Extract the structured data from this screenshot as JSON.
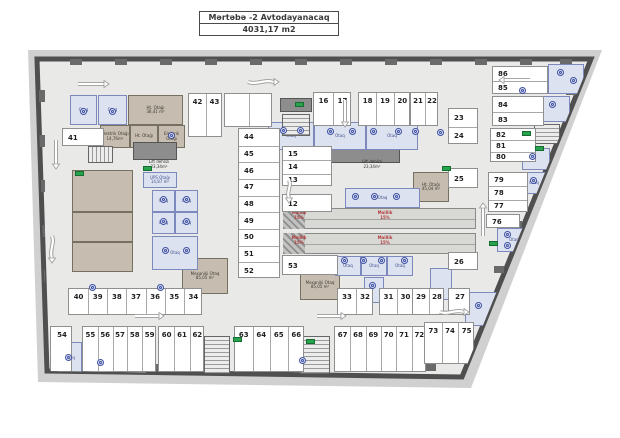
{
  "title": {
    "line1": "Mərtəbə -2 Avtodayanacaq",
    "line2": "4031,17 m2"
  },
  "plan": {
    "colors": {
      "wall": "#4f4f4f",
      "floor": "#e9e9e7",
      "outer_band": "#d0d0d0",
      "stall": "#ffffff",
      "tan_room": "#c6bdb0",
      "blue_room": "#dde2f1",
      "ramp_text": "#b23b3b",
      "exit_green": "#28a24c",
      "vent_blue": "#3f51a3"
    },
    "outline": [
      [
        37,
        59
      ],
      [
        591,
        59
      ],
      [
        462,
        377
      ],
      [
        47,
        371
      ]
    ],
    "outer_band": [
      [
        28,
        50
      ],
      [
        602,
        50
      ],
      [
        471,
        388
      ],
      [
        38,
        382
      ]
    ],
    "stall_groups": [
      {
        "orient": "v",
        "x": 313,
        "y": 92,
        "w": 38,
        "h": 34,
        "numbers": [
          "16",
          "17"
        ]
      },
      {
        "orient": "v",
        "x": 358,
        "y": 92,
        "w": 52,
        "h": 34,
        "numbers": [
          "18",
          "19",
          "20"
        ]
      },
      {
        "orient": "v",
        "x": 410,
        "y": 92,
        "w": 28,
        "h": 34,
        "numbers": [
          "21",
          "22"
        ]
      },
      {
        "orient": "v",
        "x": 188,
        "y": 93,
        "w": 34,
        "h": 44,
        "numbers": [
          "42",
          "43"
        ]
      },
      {
        "orient": "v",
        "x": 224,
        "y": 93,
        "w": 48,
        "h": 34,
        "numbers": [
          "",
          ""
        ]
      },
      {
        "orient": "h",
        "x": 62,
        "y": 128,
        "w": 42,
        "h": 18,
        "numbers": [
          "41"
        ]
      },
      {
        "orient": "h",
        "x": 238,
        "y": 128,
        "w": 42,
        "h": 150,
        "numbers": [
          "44",
          "45",
          "46",
          "47",
          "48",
          "49",
          "50",
          "51",
          "52"
        ]
      },
      {
        "orient": "h",
        "x": 282,
        "y": 146,
        "w": 50,
        "h": 40,
        "numbers": [
          "15",
          "14",
          "13"
        ]
      },
      {
        "orient": "h",
        "x": 282,
        "y": 194,
        "w": 50,
        "h": 18,
        "numbers": [
          "12"
        ]
      },
      {
        "orient": "h",
        "x": 282,
        "y": 255,
        "w": 56,
        "h": 20,
        "numbers": [
          "53"
        ]
      },
      {
        "orient": "h",
        "x": 448,
        "y": 108,
        "w": 30,
        "h": 36,
        "numbers": [
          "23",
          "24"
        ]
      },
      {
        "orient": "h",
        "x": 448,
        "y": 168,
        "w": 30,
        "h": 20,
        "numbers": [
          "25"
        ]
      },
      {
        "orient": "h",
        "x": 448,
        "y": 252,
        "w": 30,
        "h": 18,
        "numbers": [
          "26"
        ]
      },
      {
        "orient": "h",
        "x": 492,
        "y": 66,
        "w": 56,
        "h": 28,
        "numbers": [
          "86",
          "85"
        ]
      },
      {
        "orient": "h",
        "x": 492,
        "y": 96,
        "w": 52,
        "h": 30,
        "numbers": [
          "84",
          "83"
        ]
      },
      {
        "orient": "h",
        "x": 490,
        "y": 128,
        "w": 46,
        "h": 34,
        "numbers": [
          "82",
          "81",
          "80"
        ]
      },
      {
        "orient": "h",
        "x": 488,
        "y": 172,
        "w": 40,
        "h": 40,
        "numbers": [
          "79",
          "78",
          "77"
        ]
      },
      {
        "orient": "h",
        "x": 486,
        "y": 214,
        "w": 34,
        "h": 14,
        "numbers": [
          "76"
        ]
      },
      {
        "orient": "v",
        "x": 68,
        "y": 288,
        "w": 134,
        "h": 27,
        "numbers": [
          "40",
          "39",
          "38",
          "37",
          "36",
          "35",
          "34"
        ]
      },
      {
        "orient": "v",
        "x": 337,
        "y": 288,
        "w": 36,
        "h": 27,
        "numbers": [
          "33",
          "32"
        ]
      },
      {
        "orient": "v",
        "x": 379,
        "y": 288,
        "w": 34,
        "h": 27,
        "numbers": [
          "31",
          "30"
        ]
      },
      {
        "orient": "v",
        "x": 412,
        "y": 288,
        "w": 32,
        "h": 27,
        "numbers": [
          "29",
          "28"
        ]
      },
      {
        "orient": "v",
        "x": 448,
        "y": 288,
        "w": 22,
        "h": 27,
        "numbers": [
          "27"
        ]
      },
      {
        "orient": "v",
        "x": 50,
        "y": 326,
        "w": 22,
        "h": 46,
        "numbers": [
          "54"
        ]
      },
      {
        "orient": "v",
        "x": 82,
        "y": 326,
        "w": 74,
        "h": 46,
        "numbers": [
          "55",
          "56",
          "57",
          "58",
          "59"
        ]
      },
      {
        "orient": "v",
        "x": 158,
        "y": 326,
        "w": 46,
        "h": 46,
        "numbers": [
          "60",
          "61",
          "62"
        ]
      },
      {
        "orient": "v",
        "x": 234,
        "y": 326,
        "w": 70,
        "h": 46,
        "numbers": [
          "63",
          "64",
          "65",
          "66"
        ]
      },
      {
        "orient": "v",
        "x": 334,
        "y": 326,
        "w": 92,
        "h": 46,
        "numbers": [
          "67",
          "68",
          "69",
          "70",
          "71",
          "72"
        ]
      },
      {
        "orient": "v",
        "x": 424,
        "y": 322,
        "w": 50,
        "h": 42,
        "numbers": [
          "73",
          "74",
          "75"
        ]
      }
    ],
    "rooms": [
      {
        "type": "blue",
        "x": 70,
        "y": 95,
        "w": 27,
        "h": 30,
        "label": "Otaq"
      },
      {
        "type": "blue",
        "x": 98,
        "y": 95,
        "w": 29,
        "h": 30,
        "label": "Otaq"
      },
      {
        "type": "tan",
        "x": 128,
        "y": 95,
        "w": 55,
        "h": 30,
        "label": "Ht. Otağı\n38,41 m²"
      },
      {
        "type": "tan",
        "x": 100,
        "y": 125,
        "w": 30,
        "h": 23,
        "label": "Elektrik Otağı\n14,76m²"
      },
      {
        "type": "tan",
        "x": 130,
        "y": 125,
        "w": 28,
        "h": 23,
        "label": "Ht. Otağı"
      },
      {
        "type": "tan",
        "x": 158,
        "y": 125,
        "w": 27,
        "h": 23,
        "label": "Elektrik\nOtağı"
      },
      {
        "type": "tan",
        "x": 72,
        "y": 170,
        "w": 61,
        "h": 42,
        "label": ""
      },
      {
        "type": "tan",
        "x": 72,
        "y": 212,
        "w": 61,
        "h": 30,
        "label": ""
      },
      {
        "type": "tan",
        "x": 72,
        "y": 242,
        "w": 61,
        "h": 30,
        "label": ""
      },
      {
        "type": "tan",
        "x": 182,
        "y": 258,
        "w": 46,
        "h": 36,
        "label": "Mexaniki Otaq\n85,05 m²"
      },
      {
        "type": "tan",
        "x": 300,
        "y": 270,
        "w": 40,
        "h": 30,
        "label": "Mexaniki Otaq\n85,05 m²"
      },
      {
        "type": "tan",
        "x": 413,
        "y": 172,
        "w": 36,
        "h": 30,
        "label": "Ht. Otağı\n45,04 m²"
      },
      {
        "type": "shaft",
        "x": 133,
        "y": 142,
        "w": 44,
        "h": 18,
        "label": ""
      },
      {
        "type": "shaft",
        "x": 322,
        "y": 145,
        "w": 78,
        "h": 18,
        "label": ""
      },
      {
        "type": "shaft",
        "x": 280,
        "y": 98,
        "w": 32,
        "h": 14,
        "label": ""
      },
      {
        "type": "blue",
        "x": 143,
        "y": 172,
        "w": 34,
        "h": 16,
        "label": "UPS Otağı\n14,87 m²"
      },
      {
        "type": "blue",
        "x": 152,
        "y": 190,
        "w": 23,
        "h": 22,
        "label": "Otaq"
      },
      {
        "type": "blue",
        "x": 175,
        "y": 190,
        "w": 23,
        "h": 22,
        "label": "Otaq"
      },
      {
        "type": "blue",
        "x": 152,
        "y": 212,
        "w": 23,
        "h": 22,
        "label": "Otaq"
      },
      {
        "type": "blue",
        "x": 175,
        "y": 212,
        "w": 23,
        "h": 22,
        "label": "Otaq"
      },
      {
        "type": "blue",
        "x": 152,
        "y": 236,
        "w": 46,
        "h": 34,
        "label": "Otaq"
      },
      {
        "type": "blue",
        "x": 268,
        "y": 122,
        "w": 46,
        "h": 28,
        "label": "Otaq"
      },
      {
        "type": "blue",
        "x": 314,
        "y": 122,
        "w": 52,
        "h": 28,
        "label": "Otaq"
      },
      {
        "type": "blue",
        "x": 366,
        "y": 122,
        "w": 52,
        "h": 28,
        "label": "Otaq"
      },
      {
        "type": "blue",
        "x": 345,
        "y": 188,
        "w": 75,
        "h": 20,
        "label": "Otaq"
      },
      {
        "type": "blue",
        "x": 335,
        "y": 256,
        "w": 26,
        "h": 20,
        "label": "Otaq"
      },
      {
        "type": "blue",
        "x": 361,
        "y": 256,
        "w": 26,
        "h": 20,
        "label": "Otaq"
      },
      {
        "type": "blue",
        "x": 387,
        "y": 256,
        "w": 26,
        "h": 20,
        "label": "Otaq"
      },
      {
        "type": "blue",
        "x": 364,
        "y": 277,
        "w": 20,
        "h": 26,
        "label": ""
      },
      {
        "type": "blue",
        "x": 430,
        "y": 268,
        "w": 22,
        "h": 32,
        "label": ""
      },
      {
        "type": "blue",
        "x": 58,
        "y": 342,
        "w": 24,
        "h": 32,
        "label": "Otaq"
      },
      {
        "type": "blue",
        "x": 84,
        "y": 352,
        "w": 62,
        "h": 24,
        "label": "Otaq"
      },
      {
        "type": "blue",
        "x": 548,
        "y": 64,
        "w": 36,
        "h": 30,
        "label": ""
      },
      {
        "type": "blue",
        "x": 540,
        "y": 96,
        "w": 30,
        "h": 26,
        "label": ""
      },
      {
        "type": "blue",
        "x": 522,
        "y": 148,
        "w": 28,
        "h": 22,
        "label": ""
      },
      {
        "type": "blue",
        "x": 520,
        "y": 172,
        "w": 28,
        "h": 22,
        "label": "Otaq"
      },
      {
        "type": "blue",
        "x": 497,
        "y": 228,
        "w": 34,
        "h": 24,
        "label": "Otaq"
      },
      {
        "type": "blue",
        "x": 514,
        "y": 262,
        "w": 26,
        "h": 36,
        "label": ""
      },
      {
        "type": "blue",
        "x": 465,
        "y": 292,
        "w": 32,
        "h": 34,
        "label": ""
      }
    ],
    "labels": [
      {
        "x": 136,
        "y": 160,
        "w": 46,
        "text": "Lift dehlizi\n23,34m²"
      },
      {
        "x": 348,
        "y": 160,
        "w": 48,
        "text": "Lift dehlizi\n23,34m²"
      }
    ],
    "ramps": {
      "bands": [
        {
          "x": 283,
          "y": 208,
          "w": 193,
          "h": 21
        },
        {
          "x": 283,
          "y": 233,
          "w": 193,
          "h": 21
        }
      ],
      "hatches": [
        {
          "x": 283,
          "y": 208,
          "w": 22,
          "h": 21
        },
        {
          "x": 283,
          "y": 233,
          "w": 22,
          "h": 21
        }
      ],
      "labels": [
        {
          "x": 286,
          "y": 211,
          "w": 26,
          "text": "Maillik\n15%"
        },
        {
          "x": 372,
          "y": 211,
          "w": 26,
          "text": "Maillik\n15%"
        },
        {
          "x": 286,
          "y": 236,
          "w": 26,
          "text": "Maillik\n15%"
        },
        {
          "x": 372,
          "y": 236,
          "w": 26,
          "text": "Maillik\n15%"
        }
      ]
    },
    "edge_label": {
      "text": "Maillik 15%",
      "cx": 34,
      "cy": 107,
      "len": 82
    },
    "stairs": [
      {
        "x": 88,
        "y": 146,
        "w": 25,
        "h": 17,
        "dir": "v"
      },
      {
        "x": 282,
        "y": 114,
        "w": 28,
        "h": 22,
        "dir": "h"
      },
      {
        "x": 534,
        "y": 124,
        "w": 26,
        "h": 20,
        "dir": "h"
      },
      {
        "x": 204,
        "y": 336,
        "w": 26,
        "h": 38,
        "dir": "h"
      },
      {
        "x": 300,
        "y": 336,
        "w": 30,
        "h": 38,
        "dir": "h"
      }
    ],
    "arrows": [
      {
        "x": 78,
        "y": 84,
        "dir": "right",
        "len": 26,
        "type": "straight"
      },
      {
        "x": 248,
        "y": 82,
        "dir": "right",
        "len": 26,
        "type": "curve"
      },
      {
        "x": 530,
        "y": 80,
        "dir": "left",
        "len": 26,
        "type": "straight"
      },
      {
        "x": 56,
        "y": 140,
        "dir": "down",
        "len": 24,
        "type": "straight"
      },
      {
        "x": 52,
        "y": 236,
        "dir": "down",
        "len": 22,
        "type": "curve"
      },
      {
        "x": 345,
        "y": 100,
        "dir": "down",
        "len": 22,
        "type": "straight"
      },
      {
        "x": 289,
        "y": 180,
        "dir": "down",
        "len": 18,
        "type": "curve"
      },
      {
        "x": 483,
        "y": 236,
        "dir": "up",
        "len": 28,
        "type": "straight"
      },
      {
        "x": 135,
        "y": 316,
        "dir": "right",
        "len": 24,
        "type": "straight"
      },
      {
        "x": 317,
        "y": 316,
        "dir": "right",
        "len": 24,
        "type": "straight"
      },
      {
        "x": 440,
        "y": 312,
        "dir": "right",
        "len": 24,
        "type": "curve"
      }
    ],
    "exit_signs": [
      [
        295,
        102
      ],
      [
        442,
        166
      ],
      [
        535,
        146
      ],
      [
        489,
        241
      ],
      [
        306,
        339
      ],
      [
        75,
        171
      ],
      [
        233,
        337
      ],
      [
        143,
        166
      ],
      [
        522,
        131
      ]
    ],
    "vent_icons": [
      [
        83,
        111
      ],
      [
        112,
        111
      ],
      [
        171,
        135
      ],
      [
        163,
        199
      ],
      [
        186,
        199
      ],
      [
        163,
        221
      ],
      [
        186,
        221
      ],
      [
        165,
        250
      ],
      [
        186,
        250
      ],
      [
        283,
        130
      ],
      [
        300,
        130
      ],
      [
        330,
        131
      ],
      [
        352,
        131
      ],
      [
        373,
        131
      ],
      [
        398,
        131
      ],
      [
        415,
        131
      ],
      [
        355,
        196
      ],
      [
        374,
        196
      ],
      [
        396,
        196
      ],
      [
        344,
        260
      ],
      [
        363,
        260
      ],
      [
        381,
        260
      ],
      [
        404,
        260
      ],
      [
        560,
        72
      ],
      [
        573,
        80
      ],
      [
        552,
        104
      ],
      [
        532,
        156
      ],
      [
        533,
        180
      ],
      [
        507,
        234
      ],
      [
        507,
        245
      ],
      [
        524,
        278
      ],
      [
        478,
        305
      ],
      [
        372,
        285
      ],
      [
        302,
        360
      ],
      [
        100,
        362
      ],
      [
        68,
        357
      ],
      [
        92,
        287
      ],
      [
        160,
        287
      ],
      [
        440,
        132
      ],
      [
        522,
        90
      ]
    ]
  }
}
